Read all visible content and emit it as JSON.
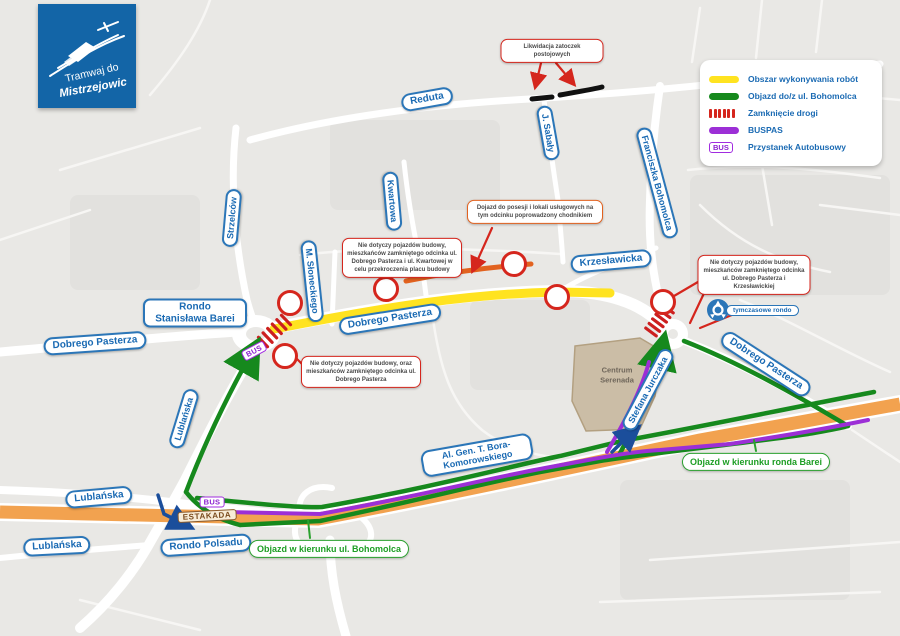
{
  "logo": {
    "line1": "Tramwaj do",
    "line2": "Mistrzejowic"
  },
  "legend": {
    "items": [
      {
        "swatch": "work-area",
        "color": "#ffe320",
        "label": "Obszar wykonywania robót"
      },
      {
        "swatch": "detour",
        "color": "#16891d",
        "label": "Objazd do/z ul. Bohomolca"
      },
      {
        "swatch": "road-closed",
        "color": "#d5261d",
        "label": "Zamknięcie drogi"
      },
      {
        "swatch": "buslane",
        "color": "#9c2fd6",
        "label": "BUSPAS"
      },
      {
        "swatch": "bus-stop",
        "color": "#a12ce0",
        "label": "Przystanek Autobusowy"
      }
    ]
  },
  "streets": {
    "reduta": "Reduta",
    "sabaly": "J. Sabały",
    "strzelcow": "Strzelców",
    "kwartowa": "Kwartowa",
    "sloneckiego": "M. Słoneckiego",
    "bohomolca": "Franciszka Bohomolca",
    "krzeslawicka": "Krzesławicka",
    "dobrego_pasterza": "Dobrego Pasterza",
    "lublanska": "Lublańska",
    "jurczaka": "Stefana Jurczaka",
    "bora_komorowskiego": "Al. Gen. T. Bora-Komorowskiego",
    "rondo_barei": "Rondo Stanisława Barei",
    "rondo_polsadu": "Rondo Polsadu"
  },
  "badges": {
    "bus": "BUS",
    "estakada": "ESTAKADA",
    "tymczasowe_rondo": "tymczasowe rondo"
  },
  "places": {
    "centrum_serenada": "Centrum Serenada"
  },
  "callouts": {
    "likwidacja": "Likwidacja zatoczek postojowych",
    "kwartowa_closure": "Nie dotyczy pojazdów budowy, mieszkańców zamkniętego odcinka ul. Dobrego Pasterza i ul. Kwartowej w celu przekroczenia placu budowy",
    "dojazd_chodnikiem": "Dojazd do posesji i lokali usługowych na tym odcinku poprowadzony chodnikiem",
    "krzeslawicka_closure": "Nie dotyczy pojazdów budowy, mieszkańców zamkniętego odcinka ul. Dobrego Pasterza i Krzesławickiej",
    "pasterza_closure": "Nie dotyczy pojazdów budowy, oraz mieszkańców zamkniętego odcinka ul. Dobrego Pasterza",
    "objazd_bohomolca": "Objazd w kierunku ul. Bohomolca",
    "objazd_barei": "Objazd w kierunku ronda Barei"
  },
  "colors": {
    "work_area_yellow": "#ffe320",
    "detour_green": "#16891d",
    "closure_red": "#d5261d",
    "buspas_purple": "#9c2fd6",
    "highway_orange": "#f2a24f",
    "sidewalk_detour_orange": "#e2621f",
    "label_blue": "#1a6ab3",
    "logo_blue": "#1365a7",
    "map_background": "#e9e8e5"
  }
}
